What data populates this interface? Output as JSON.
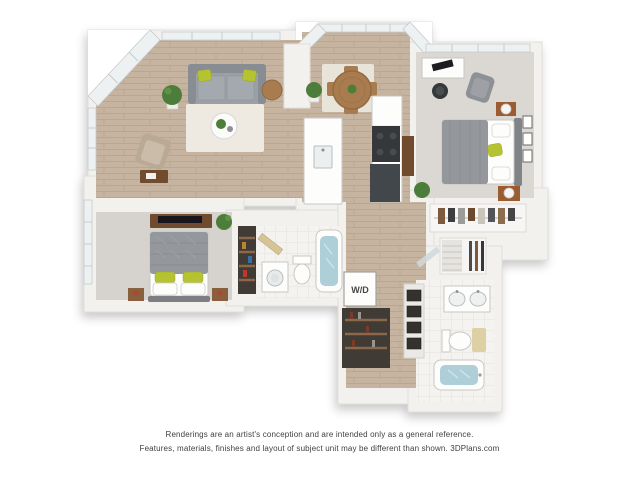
{
  "plan": {
    "wd_label": "W/D"
  },
  "disclaimer": {
    "line1": "Renderings are an artist's conception and are intended only as a general reference.",
    "line2": "Features, materials, finishes and layout of subject unit may be different than shown. 3DPlans.com"
  },
  "colors": {
    "wall_color": "#f2f1ee",
    "wall_edge": "#e2dfdb",
    "wood_floor": "#c6b4a0",
    "wood_line": "#b4a38e",
    "carpet_1": "#dbd7d2",
    "carpet_2": "#d6d2cd",
    "tile_base": "#f4f3f0",
    "tile_line": "#e0ded9",
    "rug_living": "#eeeae1",
    "rug_dining": "#e9e4da",
    "sofa": "#9aa0a5",
    "sofa_dark": "#878d93",
    "bed_blanket": "#94979c",
    "accent_green": "#b5c332",
    "wood_furniture": "#a87c50",
    "wood_dark": "#6f4b2e",
    "closet_dark": "#3f3b36",
    "shelf_wood": "#8a6848",
    "appliance_dark": "#35373a",
    "water": "#aecfd8",
    "plant_green": "#4e7d3a",
    "white_fixture": "#fdfdfc",
    "fixture_edge": "#c9c7c3",
    "window_glass": "#eef1f2",
    "text_color": "#3f3f3f"
  }
}
